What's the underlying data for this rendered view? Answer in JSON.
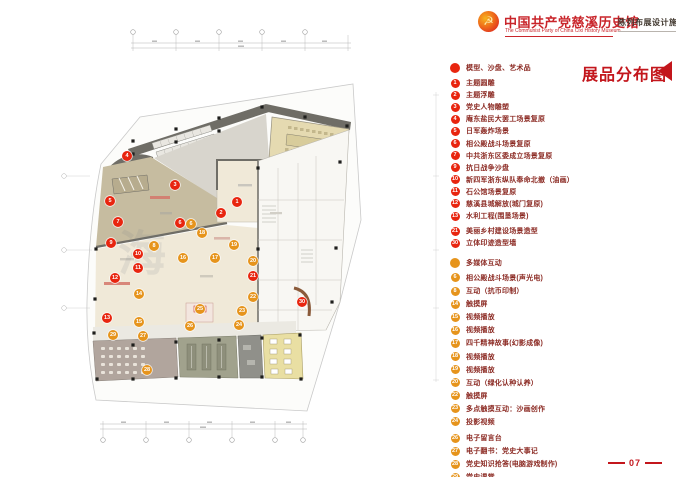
{
  "header": {
    "logo_icon": "party-emblem",
    "title": "中国共产党慈溪历史馆",
    "subtitle": "The Communist Party of China Cixi  History Museum",
    "doc_title": "陈列布展设计施工方案"
  },
  "legend": {
    "title": "展品分布图",
    "sections": [
      {
        "type": "red",
        "header": "模型、沙盘、艺术品",
        "items": [
          {
            "num": "1",
            "label": "主题圆雕"
          },
          {
            "num": "2",
            "label": "主题浮雕"
          },
          {
            "num": "3",
            "label": "党史人物雕塑"
          },
          {
            "num": "4",
            "label": "庵东盐民大罢工场景复原"
          },
          {
            "num": "5",
            "label": "日军轰炸场景"
          },
          {
            "num": "6",
            "label": "相公殿战斗场景复原"
          },
          {
            "num": "7",
            "label": "中共浙东区委成立场景复原"
          },
          {
            "num": "9",
            "label": "抗日战争沙盘"
          },
          {
            "num": "10",
            "label": "新四军浙东纵队奉命北撤（油画）"
          },
          {
            "num": "11",
            "label": "石公馆场景复原"
          },
          {
            "num": "12",
            "label": "慈溪县城解放(城门复原)"
          },
          {
            "num": "13",
            "label": "水利工程(围垦场景)"
          },
          {
            "num": "21",
            "label": "美丽乡村建设场景造型",
            "gap": true
          },
          {
            "num": "30",
            "label": "立体印迹造型墙"
          }
        ]
      },
      {
        "type": "orange",
        "header": "多媒体互动",
        "items": [
          {
            "num": "6",
            "label": "相公殿战斗场景(声光电)"
          },
          {
            "num": "8",
            "label": "互动（抗币印制）"
          },
          {
            "num": "14",
            "label": "触摸屏"
          },
          {
            "num": "15",
            "label": "视频播放"
          },
          {
            "num": "16",
            "label": "视频播放"
          },
          {
            "num": "17",
            "label": "四千精神故事(幻影成像)"
          },
          {
            "num": "18",
            "label": "视频播放"
          },
          {
            "num": "19",
            "label": "视频播放"
          },
          {
            "num": "20",
            "label": "互动（绿化认种认养）"
          },
          {
            "num": "22",
            "label": "触摸屏"
          },
          {
            "num": "23",
            "label": "多点触摸互动：沙画创作"
          },
          {
            "num": "24",
            "label": "投影视频"
          },
          {
            "num": "26",
            "label": "电子留言台",
            "gap": true
          },
          {
            "num": "27",
            "label": "电子翻书：党史大事记"
          },
          {
            "num": "28",
            "label": "党史知识抢答(电脑游戏制作)"
          },
          {
            "num": "29",
            "label": "党史课堂"
          }
        ]
      }
    ]
  },
  "plan": {
    "watermark": "海",
    "markers": [
      {
        "num": "4",
        "type": "red",
        "x": 127,
        "y": 156
      },
      {
        "num": "3",
        "type": "red",
        "x": 175,
        "y": 185
      },
      {
        "num": "5",
        "type": "red",
        "x": 110,
        "y": 201
      },
      {
        "num": "1",
        "type": "red",
        "x": 237,
        "y": 202
      },
      {
        "num": "2",
        "type": "red",
        "x": 221,
        "y": 213
      },
      {
        "num": "7",
        "type": "red",
        "x": 118,
        "y": 222
      },
      {
        "num": "6",
        "type": "red",
        "x": 180,
        "y": 223
      },
      {
        "num": "9",
        "type": "red",
        "x": 111,
        "y": 243
      },
      {
        "num": "10",
        "type": "red",
        "x": 138,
        "y": 254
      },
      {
        "num": "11",
        "type": "red",
        "x": 138,
        "y": 268
      },
      {
        "num": "12",
        "type": "red",
        "x": 115,
        "y": 278
      },
      {
        "num": "13",
        "type": "red",
        "x": 107,
        "y": 318
      },
      {
        "num": "21",
        "type": "red",
        "x": 253,
        "y": 276
      },
      {
        "num": "30",
        "type": "red",
        "x": 302,
        "y": 302
      },
      {
        "num": "6",
        "type": "orange",
        "x": 191,
        "y": 224
      },
      {
        "num": "18",
        "type": "orange",
        "x": 202,
        "y": 233
      },
      {
        "num": "19",
        "type": "orange",
        "x": 234,
        "y": 245
      },
      {
        "num": "8",
        "type": "orange",
        "x": 154,
        "y": 246
      },
      {
        "num": "16",
        "type": "orange",
        "x": 183,
        "y": 258
      },
      {
        "num": "17",
        "type": "orange",
        "x": 215,
        "y": 258
      },
      {
        "num": "20",
        "type": "orange",
        "x": 253,
        "y": 261
      },
      {
        "num": "14",
        "type": "orange",
        "x": 139,
        "y": 294
      },
      {
        "num": "22",
        "type": "orange",
        "x": 253,
        "y": 297
      },
      {
        "num": "25",
        "type": "orange",
        "x": 200,
        "y": 309
      },
      {
        "num": "23",
        "type": "orange",
        "x": 242,
        "y": 311
      },
      {
        "num": "15",
        "type": "orange",
        "x": 139,
        "y": 322
      },
      {
        "num": "24",
        "type": "orange",
        "x": 239,
        "y": 325
      },
      {
        "num": "26",
        "type": "orange",
        "x": 190,
        "y": 326
      },
      {
        "num": "29",
        "type": "orange",
        "x": 113,
        "y": 335
      },
      {
        "num": "27",
        "type": "orange",
        "x": 143,
        "y": 336
      },
      {
        "num": "28",
        "type": "orange",
        "x": 147,
        "y": 370
      }
    ]
  },
  "page_number": "07",
  "colors": {
    "accent_red": "#c3161c",
    "marker_red": "#e8250f",
    "marker_orange": "#e6941c",
    "legend_text": "#8c2b24"
  }
}
